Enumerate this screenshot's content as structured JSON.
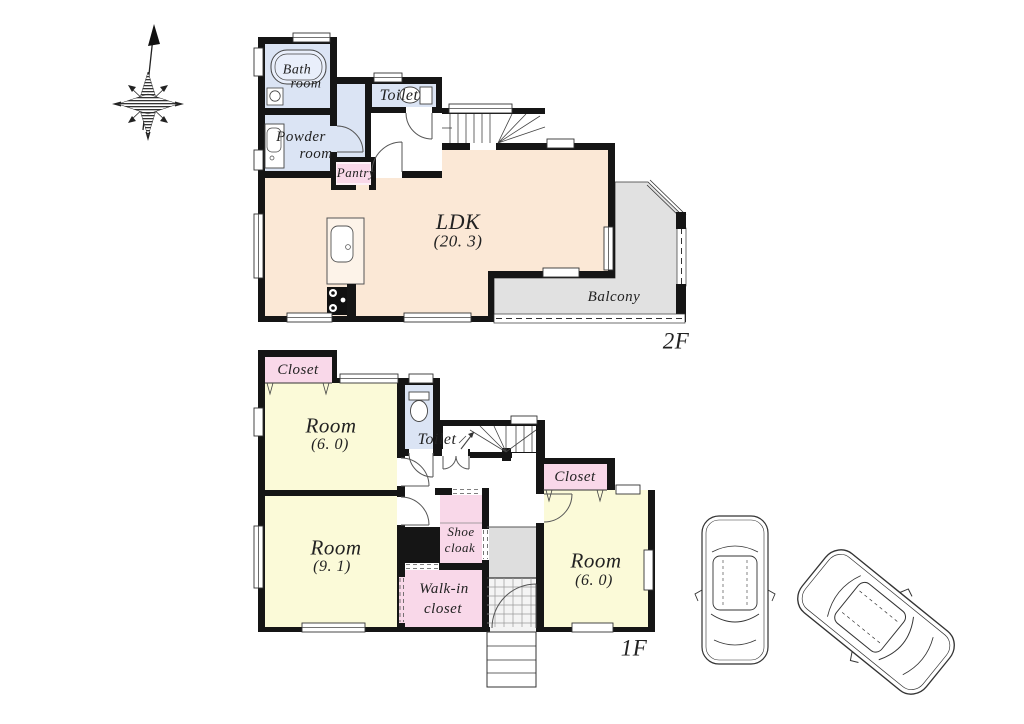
{
  "floor2": {
    "tag": "2F",
    "bath_line1": "Bath",
    "bath_line2": "room",
    "toilet": "Toilet",
    "powder_line1": "Powder",
    "powder_line2": "room",
    "pantry": "Pantry",
    "ldk_name": "LDK",
    "ldk_size": "(20. 3)",
    "balcony": "Balcony"
  },
  "floor1": {
    "tag": "1F",
    "closet_nw": "Closet",
    "room_a_name": "Room",
    "room_a_size": "(6. 0)",
    "toilet": "Toilet",
    "closet_e": "Closet",
    "room_b_name": "Room",
    "room_b_size": "(9. 1)",
    "shoe_line1": "Shoe",
    "shoe_line2": "cloak",
    "walkin_line1": "Walk-in",
    "walkin_line2": "closet",
    "room_c_name": "Room",
    "room_c_size": "(6. 0)"
  },
  "icons": {
    "compass": "north-compass-icon",
    "car1": "car-top-view",
    "car2": "car-top-view-rotated",
    "bathtub": "bathtub-icon",
    "toilet_fixture": "toilet-icon",
    "kitchen": "kitchen-counter-icon"
  },
  "colors": {
    "wall": "#151515",
    "water_blue": "#dbe4f4",
    "ldk_peach": "#fbe8d6",
    "room_yellow": "#fbfad8",
    "closet_pink": "#f9d8e9",
    "balcony_gray": "#e1e1e1",
    "entrance_gray": "#dedede",
    "label_text": "#222222"
  }
}
